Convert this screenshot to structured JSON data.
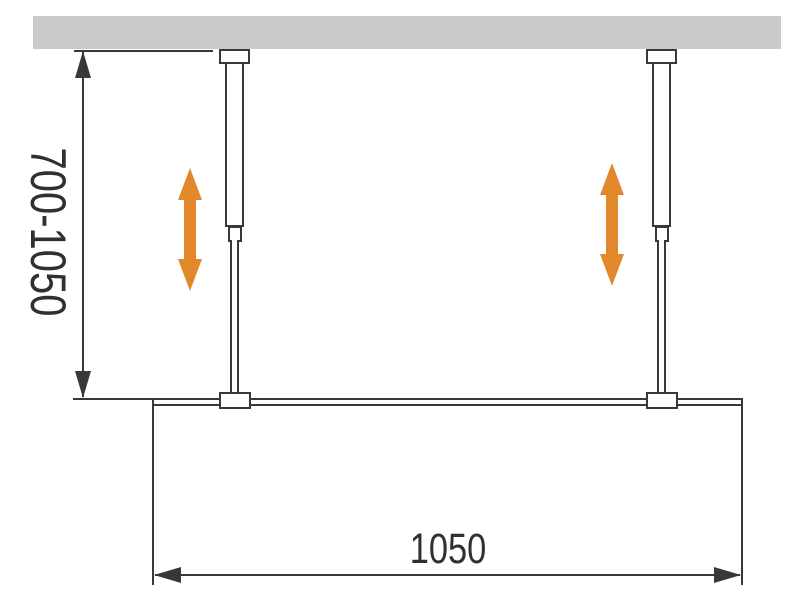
{
  "diagram": {
    "type": "technical-drawing",
    "subject": "walk-in shower glass panel hung from ceiling by two height-adjustable support bars",
    "dimensions": {
      "height_range_label": "700-1050",
      "width_label": "1050"
    }
  },
  "colors": {
    "ceiling": "#c8c9ca",
    "line": "#383838",
    "label": "#303030",
    "accent": "#e2882a",
    "bg": "#ffffff"
  }
}
